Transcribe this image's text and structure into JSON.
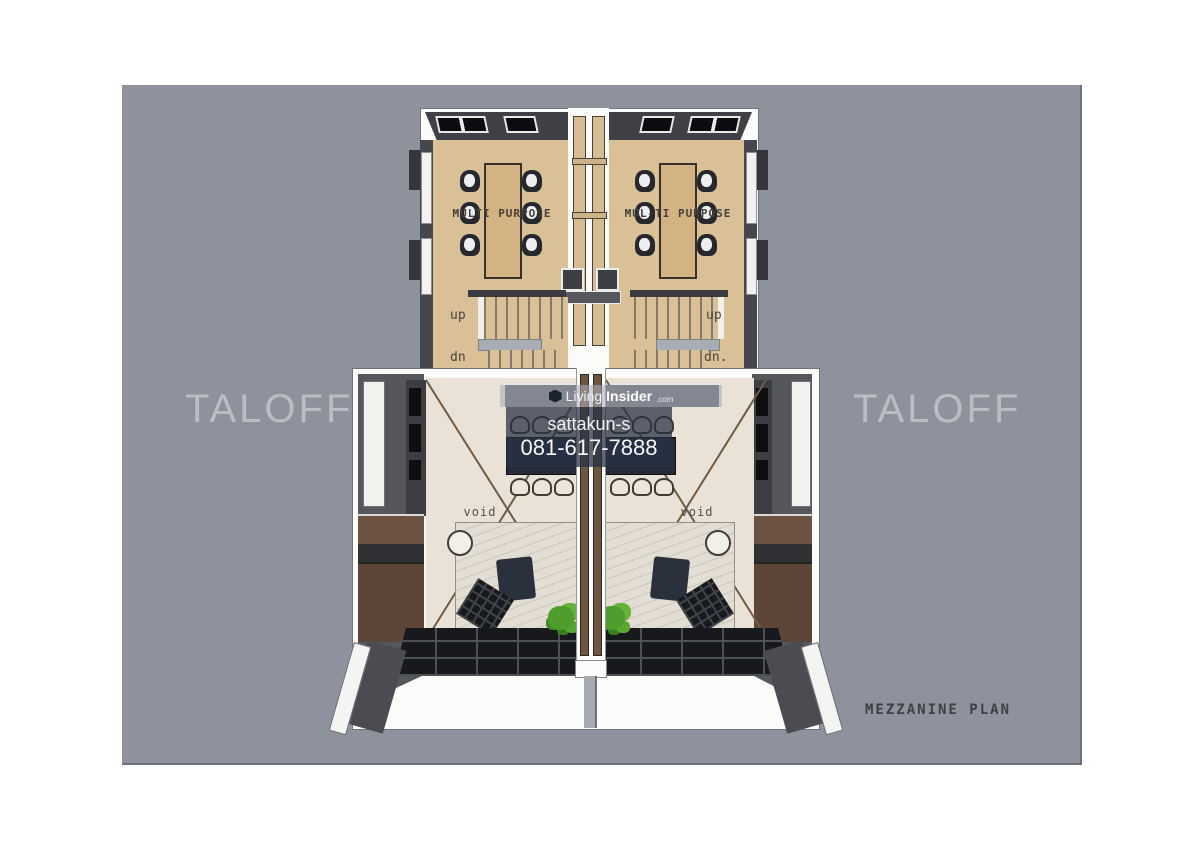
{
  "canvas": {
    "background": "#8e929c"
  },
  "watermarks": {
    "left": "TALOFF",
    "right": "TALOFF",
    "center": {
      "brand_first": "Living",
      "brand_second": "Insider",
      "brand_suffix": ".com",
      "user": "sattakun-s",
      "phone": "081-617-7888"
    }
  },
  "plan": {
    "caption": "MEZZANINE PLAN",
    "left_unit": {
      "room": "MULTI PURPOSE",
      "up": "up",
      "down": "dn",
      "void": "void"
    },
    "right_unit": {
      "room": "MUL-TI PURPOSE",
      "up": "up",
      "down": "dn.",
      "void": "void"
    }
  },
  "colors": {
    "floor_upper": "#d9c097",
    "floor_lower": "#eae2d7",
    "wall_dark": "#45474c",
    "wood": "#6b5242",
    "tile": "#17191d",
    "plant": "#4f9e2d",
    "watermark_box": "rgba(40,50,68,0.74)"
  }
}
